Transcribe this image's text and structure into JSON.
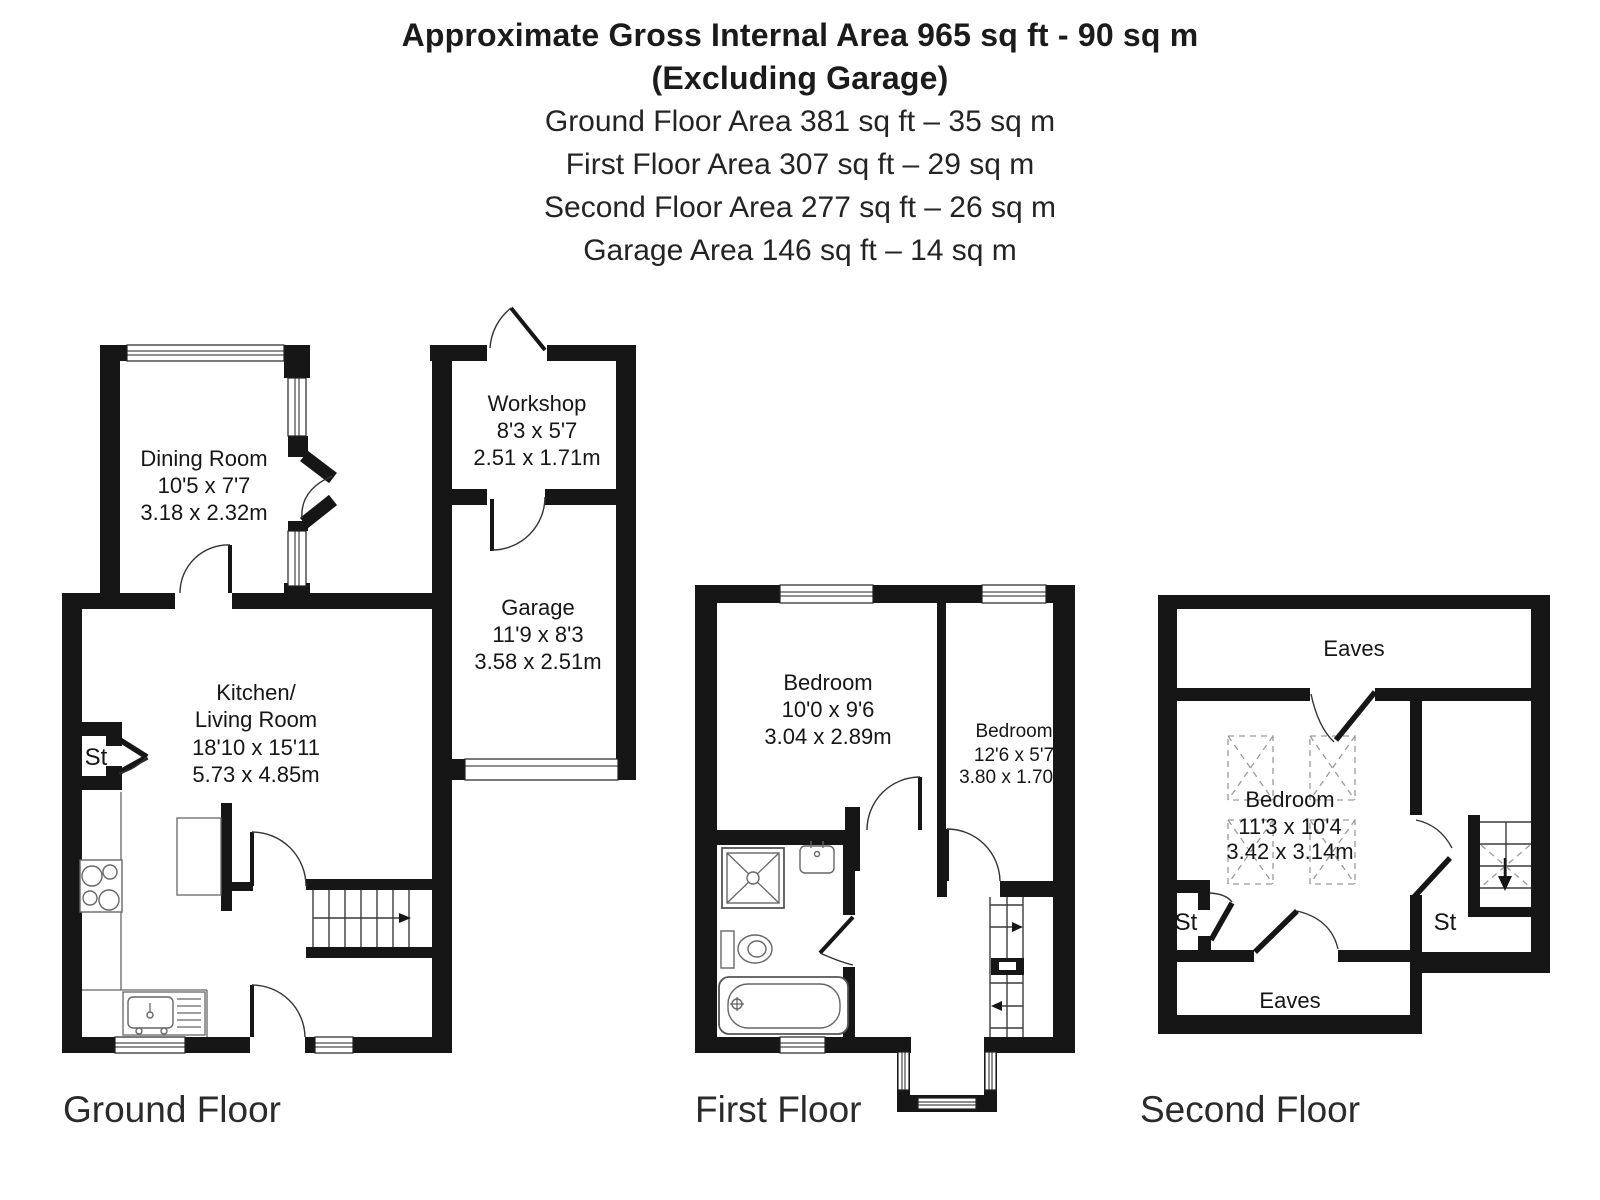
{
  "header": {
    "line1": "Approximate Gross Internal Area 965 sq ft - 90 sq m",
    "line2": "(Excluding Garage)",
    "line3": "Ground Floor Area 381 sq ft – 35 sq m",
    "line4": "First Floor Area 307 sq ft – 29 sq m",
    "line5": "Second Floor Area 277 sq ft – 26 sq m",
    "line6": "Garage Area 146 sq ft – 14 sq m"
  },
  "floors": {
    "ground": {
      "title": "Ground Floor",
      "rooms": {
        "dining": {
          "name": "Dining Room",
          "dims_ft": "10'5 x 7'7",
          "dims_m": "3.18 x 2.32m"
        },
        "workshop": {
          "name": "Workshop",
          "dims_ft": "8'3 x 5'7",
          "dims_m": "2.51 x 1.71m"
        },
        "garage": {
          "name": "Garage",
          "dims_ft": "11'9 x 8'3",
          "dims_m": "3.58 x 2.51m"
        },
        "kitchen": {
          "name_line1": "Kitchen/",
          "name_line2": "Living Room",
          "dims_ft": "18'10 x 15'11",
          "dims_m": "5.73 x 4.85m"
        },
        "store": {
          "name": "St"
        }
      }
    },
    "first": {
      "title": "First Floor",
      "rooms": {
        "bedroom1": {
          "name": "Bedroom",
          "dims_ft": "10'0 x 9'6",
          "dims_m": "3.04 x 2.89m"
        },
        "bedroom2": {
          "name": "Bedroom",
          "dims_ft": "12'6 x 5'7",
          "dims_m": "3.80 x 1.70m"
        }
      }
    },
    "second": {
      "title": "Second Floor",
      "rooms": {
        "eaves_top": {
          "name": "Eaves"
        },
        "bedroom": {
          "name": "Bedroom",
          "dims_ft": "11'3 x 10'4",
          "dims_m": "3.42 x 3.14m"
        },
        "store_left": {
          "name": "St"
        },
        "store_right": {
          "name": "St"
        },
        "eaves_bottom": {
          "name": "Eaves"
        }
      }
    }
  },
  "colors": {
    "wall": "#161616",
    "fixture_line": "#666666",
    "text": "#161616"
  }
}
